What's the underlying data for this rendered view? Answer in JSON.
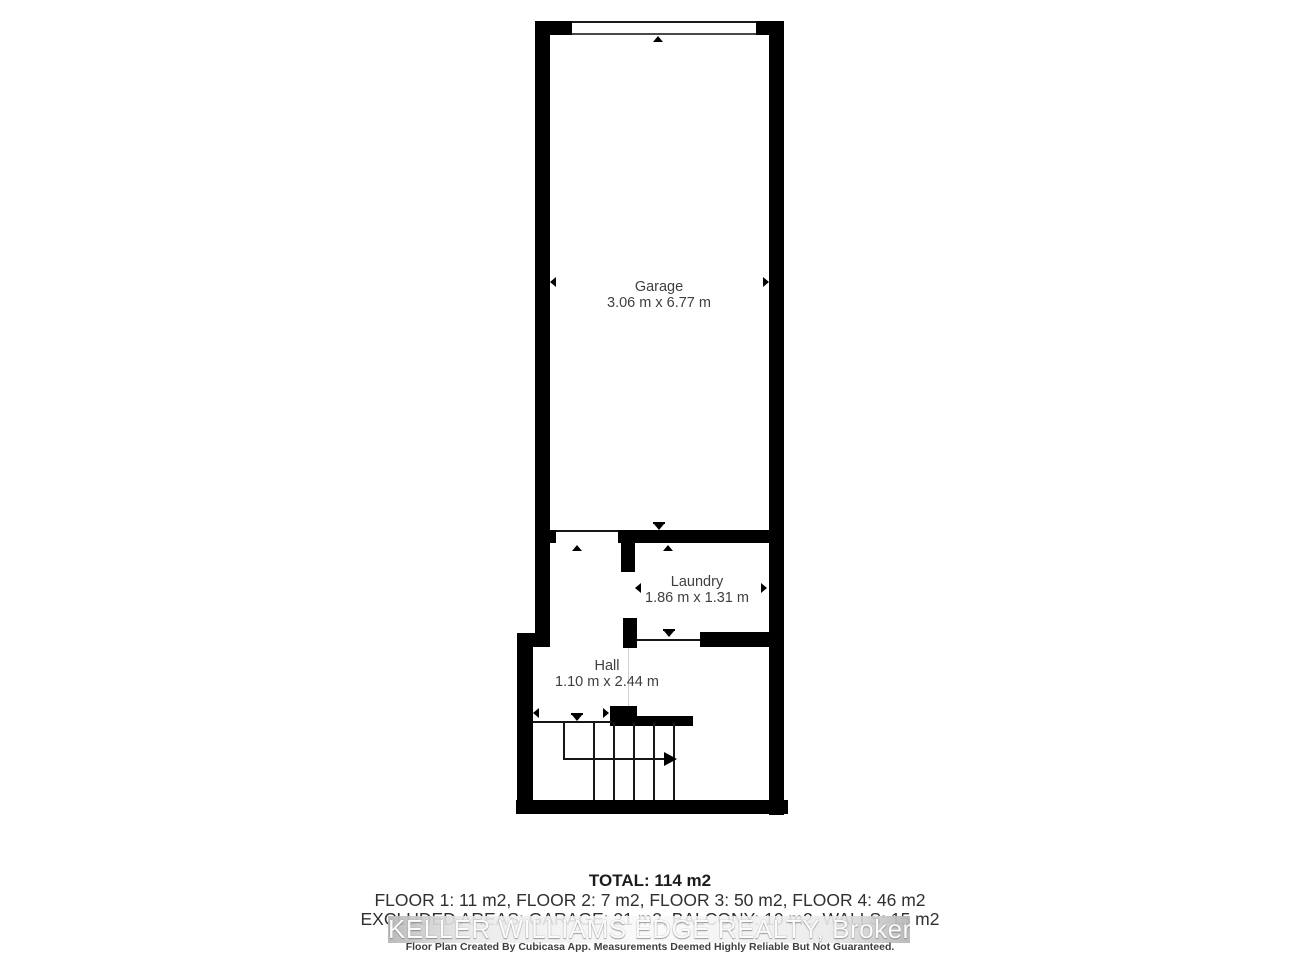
{
  "floor_plan": {
    "rooms": [
      {
        "name": "Garage",
        "dimensions": "3.06 m x 6.77 m"
      },
      {
        "name": "Laundry",
        "dimensions": "1.86 m x 1.31 m"
      },
      {
        "name": "Hall",
        "dimensions": "1.10 m x 2.44 m"
      }
    ]
  },
  "summary": {
    "total": "TOTAL: 114 m2",
    "floor_breakdown": "FLOOR 1: 11 m2, FLOOR 2: 7 m2, FLOOR 3: 50 m2, FLOOR 4: 46 m2",
    "excluded_areas": "EXCLUDED AREAS: GARAGE: 21 m2, BALCONY: 10 m2, WALLS: 15 m2"
  },
  "watermark": "KELLER WILLIAMS EDGE REALTY, Brokerage",
  "disclaimer": "Floor Plan Created By Cubicasa App. Measurements Deemed Highly Reliable But Not Guaranteed.",
  "colors": {
    "wall": "#000000",
    "room_label": "#3f3f3f",
    "summary_text": "#303030",
    "watermark_band": "#c9c9c9",
    "watermark_text": "#fbfbfb"
  }
}
